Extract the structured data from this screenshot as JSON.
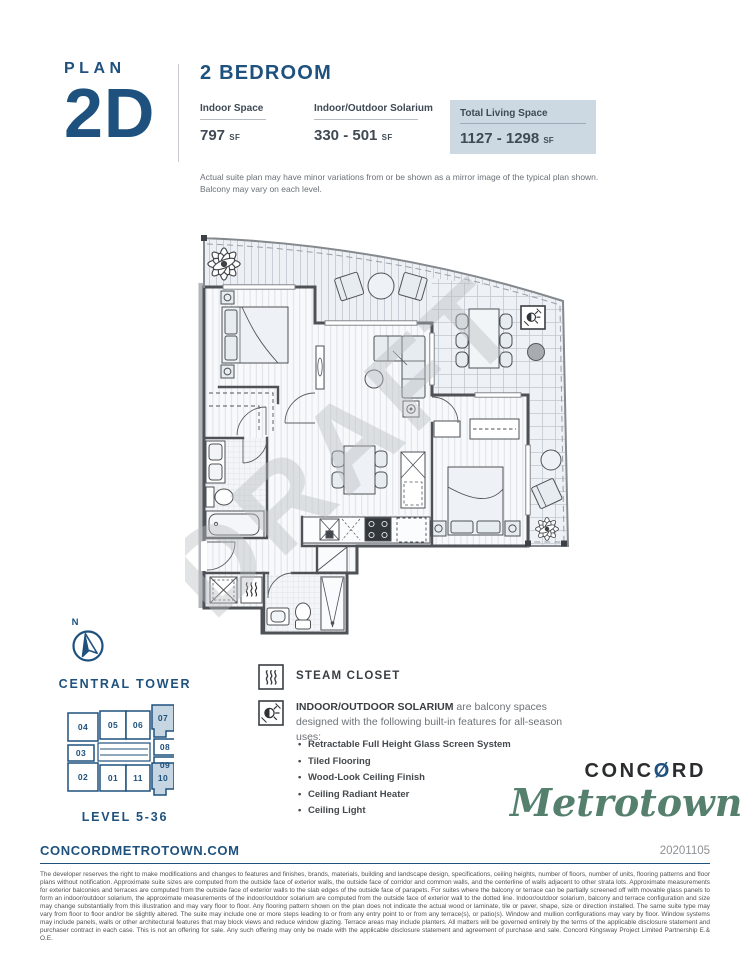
{
  "colors": {
    "navy": "#1e517e",
    "stat_box_bg": "#ccd9e3",
    "keyplate_highlight": "#c6d5e2",
    "logo_green": "#54806d",
    "logo_black": "#2a2c2e",
    "text_dark": "#3a3e42",
    "text_gray": "#6d7277"
  },
  "header": {
    "plan_label": "PLAN",
    "plan_code": "2D",
    "type_label": "2 BEDROOM",
    "stats": [
      {
        "label": "Indoor Space",
        "value": "797",
        "unit": "SF"
      },
      {
        "label": "Indoor/Outdoor Solarium",
        "value": "330 - 501",
        "unit": "SF"
      },
      {
        "label": "Total Living Space",
        "value": "1127 - 1298",
        "unit": "SF"
      }
    ],
    "disclaimer_line1": "Actual suite plan may have minor variations from or be shown as a mirror image of the typical plan shown.",
    "disclaimer_line2": "Balcony may vary on each level."
  },
  "floorplan": {
    "watermark": "DRAFT"
  },
  "compass": {
    "north_label": "N"
  },
  "keyplate": {
    "tower_label": "CENTRAL TOWER",
    "level_label": "LEVEL 5-36",
    "units": [
      {
        "id": "04"
      },
      {
        "id": "05"
      },
      {
        "id": "06"
      },
      {
        "id": "07"
      },
      {
        "id": "03"
      },
      {
        "id": "08"
      },
      {
        "id": "09"
      },
      {
        "id": "02"
      },
      {
        "id": "01"
      },
      {
        "id": "11"
      },
      {
        "id": "10"
      }
    ],
    "highlighted_units": [
      "07",
      "10"
    ]
  },
  "legend": {
    "steam": {
      "label": "STEAM CLOSET"
    },
    "solarium": {
      "title": "INDOOR/OUTDOOR SOLARIUM",
      "desc": " are balcony spaces designed with the following built-in features for all-season uses:",
      "features": [
        "Retractable Full Height Glass Screen System",
        "Tiled Flooring",
        "Wood-Look Ceiling Finish",
        "Ceiling Radiant Heater",
        "Ceiling Light"
      ]
    }
  },
  "brand": {
    "concord_pre": "CONC",
    "concord_o": "Ø",
    "concord_post": "RD",
    "metrotown": "Metrotown"
  },
  "footer": {
    "website": "CONCORDMETROTOWN.COM",
    "date_code": "20201105",
    "legal": "The developer reserves the right to make modifications and changes to features and finishes, brands, materials, building and landscape design, specifications, ceiling heights, number of floors, number of units, flooring patterns and floor plans without notification. Approximate suite sizes are computed from the outside face of exterior walls, the outside face of corridor and common walls, and the centerline of walls adjacent to other strata lots. Approximate measurements for exterior balconies and terraces are computed from the outside face of exterior walls to the slab edges of the outside face of parapets. For suites where the balcony or terrace can be partially screened off with movable glass panels to form an indoor/outdoor solarium, the approximate measurements of the indoor/outdoor solarium are computed from the outside face of exterior wall to the dotted line. Indoor/outdoor solarium, balcony and terrace configuration and size may change substantially from this illustration and may vary floor to floor. Any flooring pattern shown on the plan does not indicate the actual wood or laminate, tile or paver, shape, size or direction installed. The same suite type may vary from floor to floor and/or be slightly altered. The suite may include one or more steps leading to or from any entry point to or from any terrace(s), or patio(s). Window and mullion configurations may vary by floor. Window systems may include panels, walls or other architectural features that may block views and reduce window glazing. Terrace areas may include planters. All matters will be governed entirely by the terms of the applicable disclosure statement and purchaser contract in each case. This is not an offering for sale. Any such offering may only be made with the applicable disclosure statement and agreement of purchase and sale. Concord Kingsway Project Limited Partnership E.& O.E."
  }
}
